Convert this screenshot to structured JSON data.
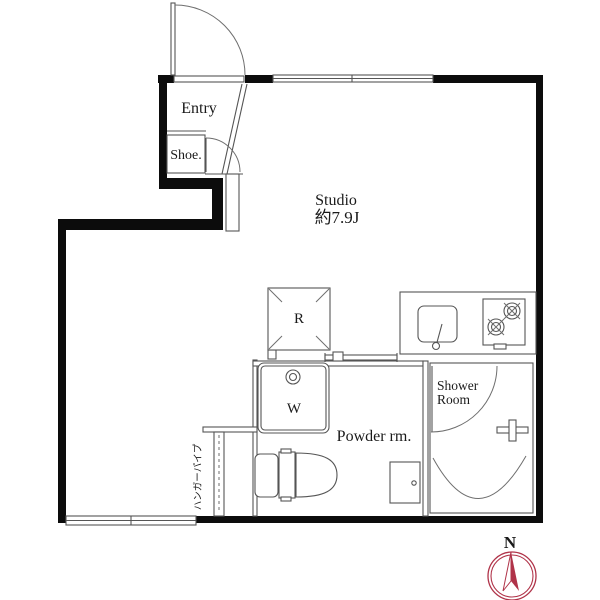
{
  "floorplan": {
    "rooms": {
      "entry": "Entry",
      "shoe": "Shoe.",
      "studio_name": "Studio",
      "studio_size": "約7.9J",
      "powder_room": "Powder rm.",
      "shower_line1": "Shower",
      "shower_line2": "Room"
    },
    "fixtures": {
      "refrigerator": "R",
      "washer": "W",
      "hanger_pipe": "ハンガーパイプ"
    },
    "compass": {
      "north": "N"
    },
    "colors": {
      "wall": "#0c0c0c",
      "line": "#555555",
      "compass": "#b03349",
      "background": "#ffffff",
      "text": "#1a1a1a"
    }
  }
}
